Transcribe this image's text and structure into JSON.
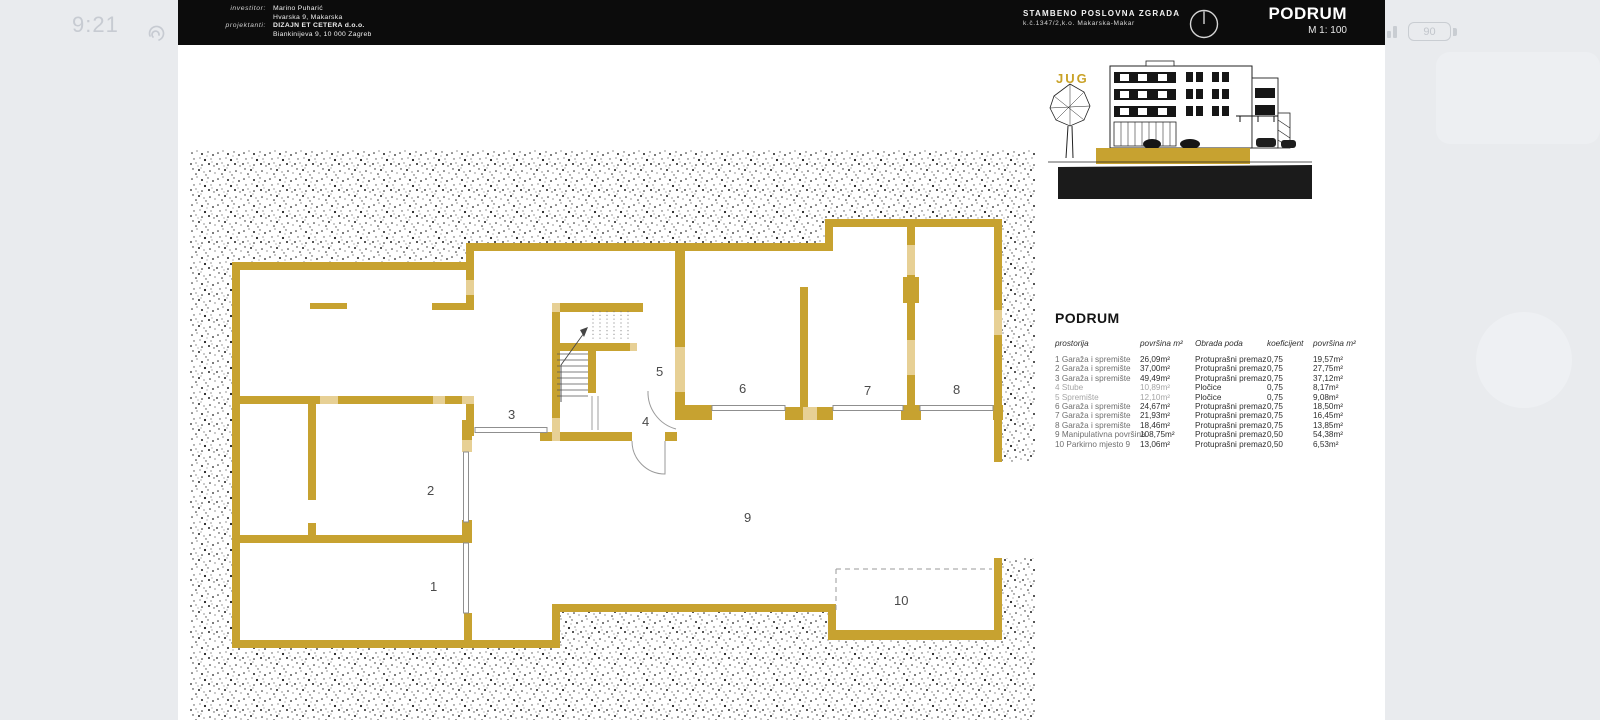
{
  "status_bar": {
    "time": "9:21",
    "battery": "90"
  },
  "title_block": {
    "investor_label": "investitor:",
    "investor_name": "Marino Puharić",
    "investor_address": "Hvarska 9, Makarska",
    "designer_label": "projektanti:",
    "designer_name": "DIZAJN ET CETERA d.o.o.",
    "designer_address": "Biankinijeva 9, 10 000 Zagreb",
    "project_title": "STAMBENO POSLOVNA ZGRADA",
    "project_parcel": "k.č.1347/2,k.o. Makarska-Makar",
    "sheet_title": "PODRUM",
    "scale": "M 1: 100"
  },
  "elevation": {
    "label": "JUG"
  },
  "plan": {
    "room_labels": [
      "1",
      "2",
      "3",
      "4",
      "5",
      "6",
      "7",
      "8",
      "9",
      "10"
    ]
  },
  "table": {
    "title": "PODRUM",
    "headers": [
      "prostorija",
      "površina m²",
      "Obrada poda",
      "koeficijent",
      "površina m²"
    ],
    "rows": [
      {
        "name": "1 Garaža i spremište",
        "area": "26,09m²",
        "finish": "Protuprašni premaz",
        "coef": "0,75",
        "net": "19,57m²"
      },
      {
        "name": "2 Garaža i spremište",
        "area": "37,00m²",
        "finish": "Protuprašni premaz",
        "coef": "0,75",
        "net": "27,75m²"
      },
      {
        "name": "3 Garaža i spremište",
        "area": "49,49m²",
        "finish": "Protuprašni premaz",
        "coef": "0,75",
        "net": "37,12m²"
      },
      {
        "name": "4 Stube",
        "area": "10,89m²",
        "finish": "Pločice",
        "coef": "0,75",
        "net": "8,17m²"
      },
      {
        "name": "5 Spremište",
        "area": "12,10m²",
        "finish": "Pločice",
        "coef": "0,75",
        "net": "9,08m²"
      },
      {
        "name": "6 Garaža i spremište",
        "area": "24,67m²",
        "finish": "Protuprašni premaz",
        "coef": "0,75",
        "net": "18,50m²"
      },
      {
        "name": "7 Garaža i spremište",
        "area": "21,93m²",
        "finish": "Protuprašni premaz",
        "coef": "0,75",
        "net": "16,45m²"
      },
      {
        "name": "8 Garaža i spremište",
        "area": "18,46m²",
        "finish": "Protuprašni premaz",
        "coef": "0,75",
        "net": "13,85m²"
      },
      {
        "name": "9 Manipulativna površina",
        "area": "108,75m²",
        "finish": "Protuprašni premaz",
        "coef": "0,50",
        "net": "54,38m²"
      },
      {
        "name": "10 Parkirno mjesto 9",
        "area": "13,06m²",
        "finish": "Protuprašni premaz",
        "coef": "0,50",
        "net": "6,53m²"
      }
    ]
  },
  "colors": {
    "wall_gold": "#c7a230",
    "wall_gold_light": "#e7d095",
    "accent_gold": "#c9a227"
  }
}
